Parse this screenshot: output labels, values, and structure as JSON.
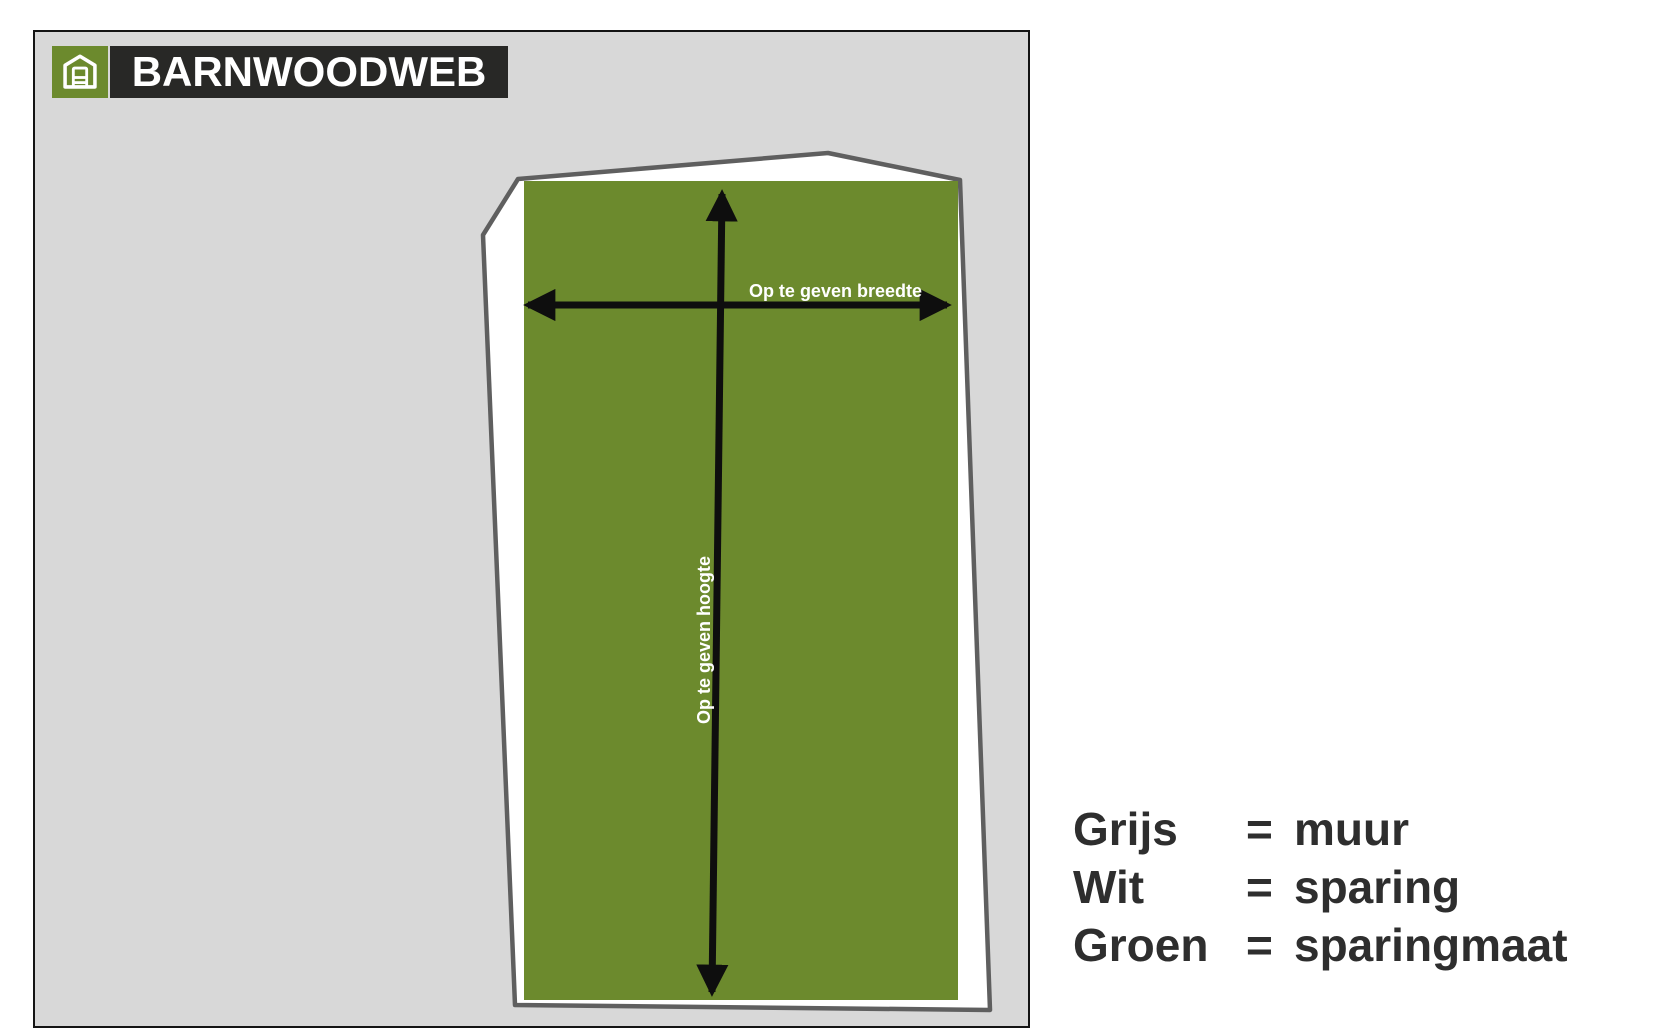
{
  "colors": {
    "wall-grey": "#d8d8d8",
    "sparing-white": "#ffffff",
    "green": "#6c8a2d",
    "outline-grey": "#5f5f5f",
    "arrow-black": "#0e0e0e",
    "logo-dark": "#282826",
    "text-dark": "#2e2e2e",
    "border-black": "#141414"
  },
  "logo": {
    "brand": "BARNWOODWEB"
  },
  "diagram": {
    "width_label": "Op te geven breedte",
    "height_label": "Op te geven hoogte"
  },
  "legend": {
    "rows": [
      {
        "label": "Grijs",
        "eq": "=",
        "value": "muur"
      },
      {
        "label": "Wit",
        "eq": "=",
        "value": "sparing"
      },
      {
        "label": "Groen",
        "eq": "=",
        "value": "sparingmaat"
      }
    ]
  }
}
